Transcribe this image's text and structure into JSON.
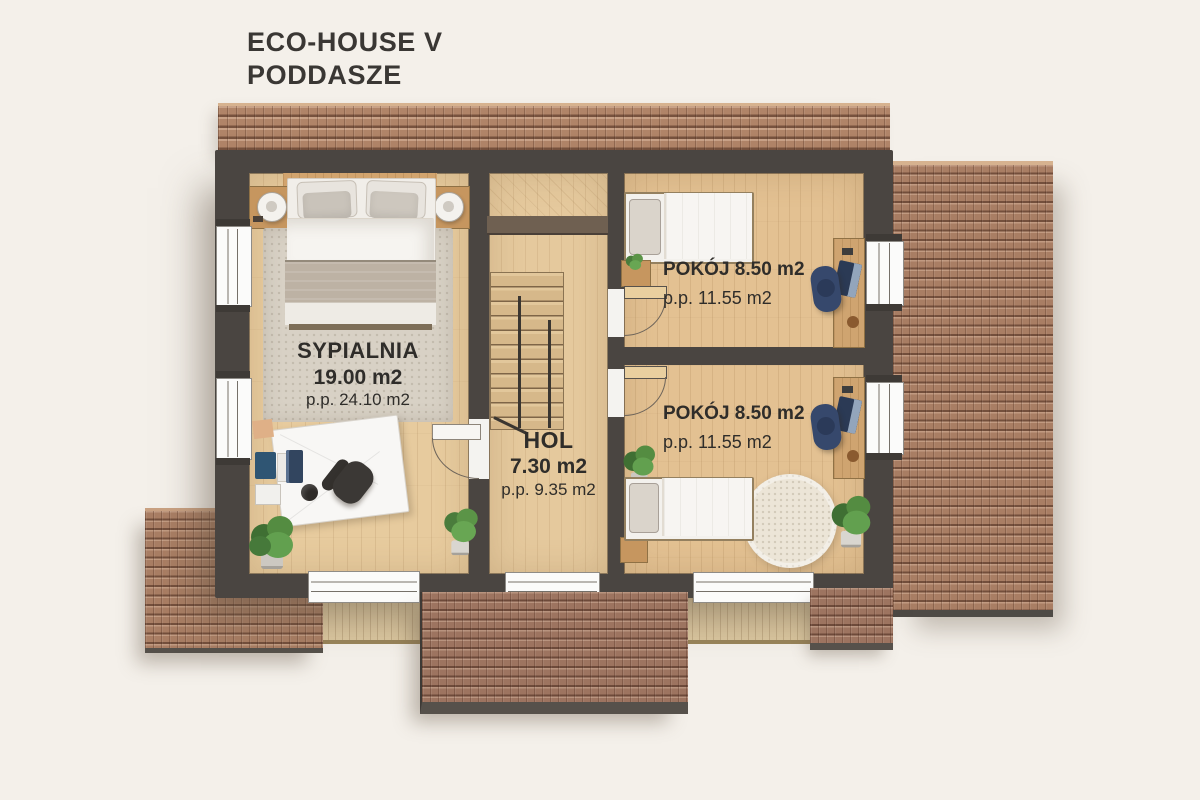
{
  "title": {
    "line1": "ECO-HOUSE V",
    "line2": "PODDASZE"
  },
  "rooms": {
    "sypialnia": {
      "name": "SYPIALNIA",
      "area": "19.00 m2",
      "usable": "p.p. 24.10 m2"
    },
    "hol": {
      "name": "HOL",
      "area": "7.30 m2",
      "usable": "p.p. 9.35 m2"
    },
    "pokoj_top": {
      "name_area": "POKÓJ 8.50 m2",
      "usable": "p.p. 11.55 m2"
    },
    "pokoj_bottom": {
      "name_area": "POKÓJ 8.50 m2",
      "usable": "p.p. 11.55 m2"
    }
  },
  "colors": {
    "background": "#f4f0ea",
    "wall": "#4a4541",
    "roof_tile": "#a97e64",
    "floor_wood": "#e6c99d",
    "floor_rooms": "#e3c192",
    "accent_navy": "#36486c",
    "text": "#2f2d2a",
    "white_fixture": "#f7f6f3"
  }
}
